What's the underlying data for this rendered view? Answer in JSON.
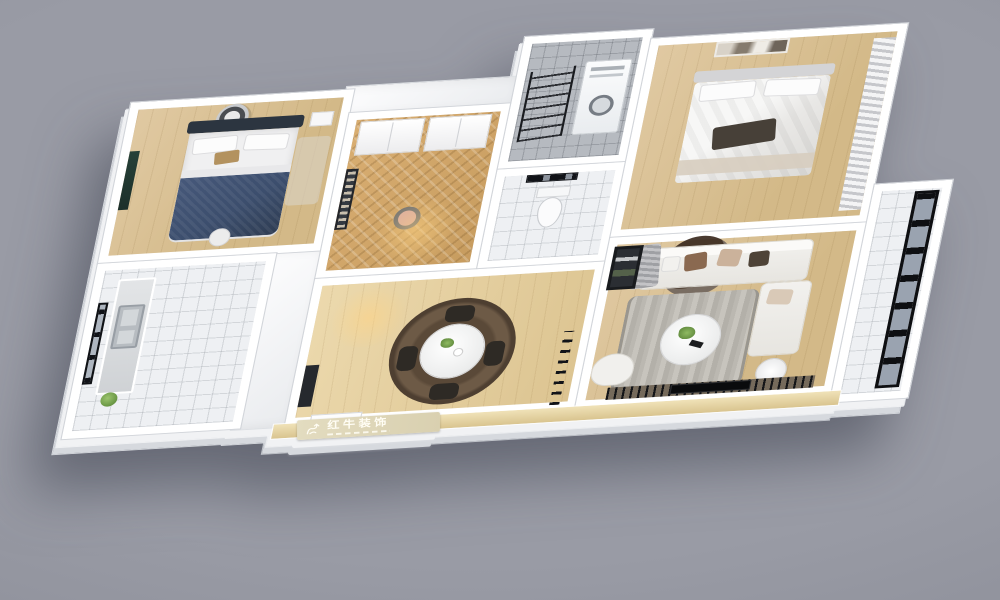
{
  "scene": {
    "rooms": [
      "bedroom-2",
      "kitchen",
      "entry-study",
      "laundry-balcony",
      "wc",
      "hallway-dining",
      "master-bedroom",
      "living-room",
      "balcony"
    ],
    "furniture": {
      "bedroom_2": [
        "ceiling-fan",
        "tv-panel",
        "double-bed-navy",
        "nightstand",
        "pouf"
      ],
      "kitchen": [
        "black-frame-window",
        "counter",
        "steel-sink",
        "plant"
      ],
      "entry_study": [
        "wardrobe-cabinets",
        "wall-bookshelf",
        "chair"
      ],
      "laundry_balcony": [
        "drying-rack",
        "washer-dryer-stack"
      ],
      "wc": [
        "toilet",
        "black-frame-window"
      ],
      "hallway_dining": [
        "round-rug",
        "dining-table",
        "dining-chairs",
        "slat-partition",
        "shoe-shelf",
        "entry-door"
      ],
      "master_bedroom": [
        "double-bed-white",
        "wall-art",
        "striped-curtain"
      ],
      "living_room": [
        "ceiling-feature",
        "sectional-sofa",
        "throw-pillows",
        "striped-rug",
        "coffee-table",
        "armchair",
        "shelf-unit",
        "side-table",
        "tv-slat-wall",
        "tv"
      ],
      "balcony": [
        "full-height-glass-wall"
      ]
    }
  },
  "brand": {
    "watermark_text": "红牛装饰",
    "logo_icon": "bull-logo"
  },
  "colors": {
    "bg": "#999ba5",
    "wall": "#ffffff",
    "wood": "#e0c9a2",
    "tile": "#eef0f3",
    "tile_gray": "#b6bac0",
    "bed_navy": "#3c4e6d",
    "headboard": "#2c3540",
    "sofa": "#f2f1ee",
    "pillow_brown": "#8a6950",
    "pillow_tan": "#cbb29b",
    "rug_gray": "#b3b0a9",
    "rug_brown": "#6d5a46",
    "frame_black": "#111318",
    "plant": "#6f9c49",
    "glass": "#9aa3b0",
    "plate": "#d9d0b0",
    "plate_text": "#fffdf4"
  }
}
